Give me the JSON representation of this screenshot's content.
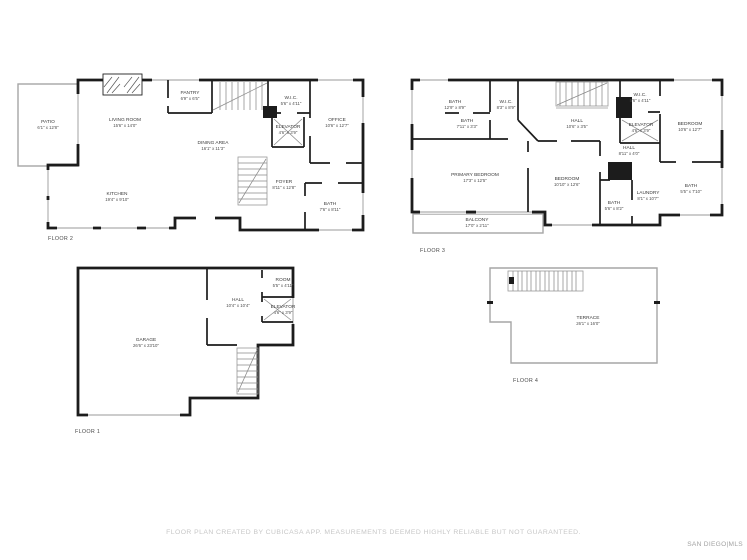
{
  "page": {
    "footer_note": "FLOOR PLAN CREATED BY CUBICASA APP. MEASUREMENTS DEEMED HIGHLY RELIABLE BUT NOT GUARANTEED.",
    "brand": "SAN DIEGO|MLS",
    "background": "#ffffff",
    "wall_color": "#1c1c1c",
    "thin_wall_color": "#a6a6a6"
  },
  "floors": [
    {
      "id": "floor-2",
      "label": "FLOOR 2",
      "rooms": [
        {
          "name": "PATIO",
          "dims": "6'1\" x 12'8\""
        },
        {
          "name": "LIVING ROOM",
          "dims": "15'6\" x 14'0\""
        },
        {
          "name": "PANTRY",
          "dims": "6'9\" x 6'5\""
        },
        {
          "name": "W.I.C.",
          "dims": "5'6\" x 4'11\""
        },
        {
          "name": "ELEVATOR",
          "dims": "4'6\" x 3'9\""
        },
        {
          "name": "OFFICE",
          "dims": "10'6\" x 12'7\""
        },
        {
          "name": "DINING AREA",
          "dims": "16'1\" x 11'3\""
        },
        {
          "name": "KITCHEN",
          "dims": "19'4\" x 9'10\""
        },
        {
          "name": "FOYER",
          "dims": "8'11\" x 12'8\""
        },
        {
          "name": "BATH",
          "dims": "7'6\" x 8'11\""
        }
      ]
    },
    {
      "id": "floor-3",
      "label": "FLOOR 3",
      "rooms": [
        {
          "name": "BATH",
          "dims": "12'9\" x 8'9\""
        },
        {
          "name": "BATH",
          "dims": "7'11\" x 3'3\""
        },
        {
          "name": "W.I.C.",
          "dims": "8'3\" x 8'9\""
        },
        {
          "name": "HALL",
          "dims": "10'6\" x 3'5\""
        },
        {
          "name": "W.I.C.",
          "dims": "5'6\" x 4'11\""
        },
        {
          "name": "ELEVATOR",
          "dims": "4'6\" x 3'9\""
        },
        {
          "name": "BEDROOM",
          "dims": "10'6\" x 12'7\""
        },
        {
          "name": "HALL",
          "dims": "8'11\" x 4'0\""
        },
        {
          "name": "PRIMARY BEDROOM",
          "dims": "17'3\" x 12'5\""
        },
        {
          "name": "BEDROOM",
          "dims": "10'10\" x 12'6\""
        },
        {
          "name": "BATH",
          "dims": "5'6\" x 8'2\""
        },
        {
          "name": "LAUNDRY",
          "dims": "8'1\" x 10'7\""
        },
        {
          "name": "BATH",
          "dims": "5'5\" x 7'10\""
        },
        {
          "name": "BALCONY",
          "dims": "17'0\" x 2'11\""
        }
      ]
    },
    {
      "id": "floor-1",
      "label": "FLOOR 1",
      "rooms": [
        {
          "name": "GARAGE",
          "dims": "26'6\" x 23'10\""
        },
        {
          "name": "HALL",
          "dims": "10'4\" x 10'4\""
        },
        {
          "name": "ROOM",
          "dims": "5'5\" x 4'11\""
        },
        {
          "name": "ELEVATOR",
          "dims": "4'6\" x 3'9\""
        }
      ]
    },
    {
      "id": "floor-4",
      "label": "FLOOR 4",
      "rooms": [
        {
          "name": "TERRACE",
          "dims": "26'1\" x 16'0\""
        }
      ]
    }
  ]
}
